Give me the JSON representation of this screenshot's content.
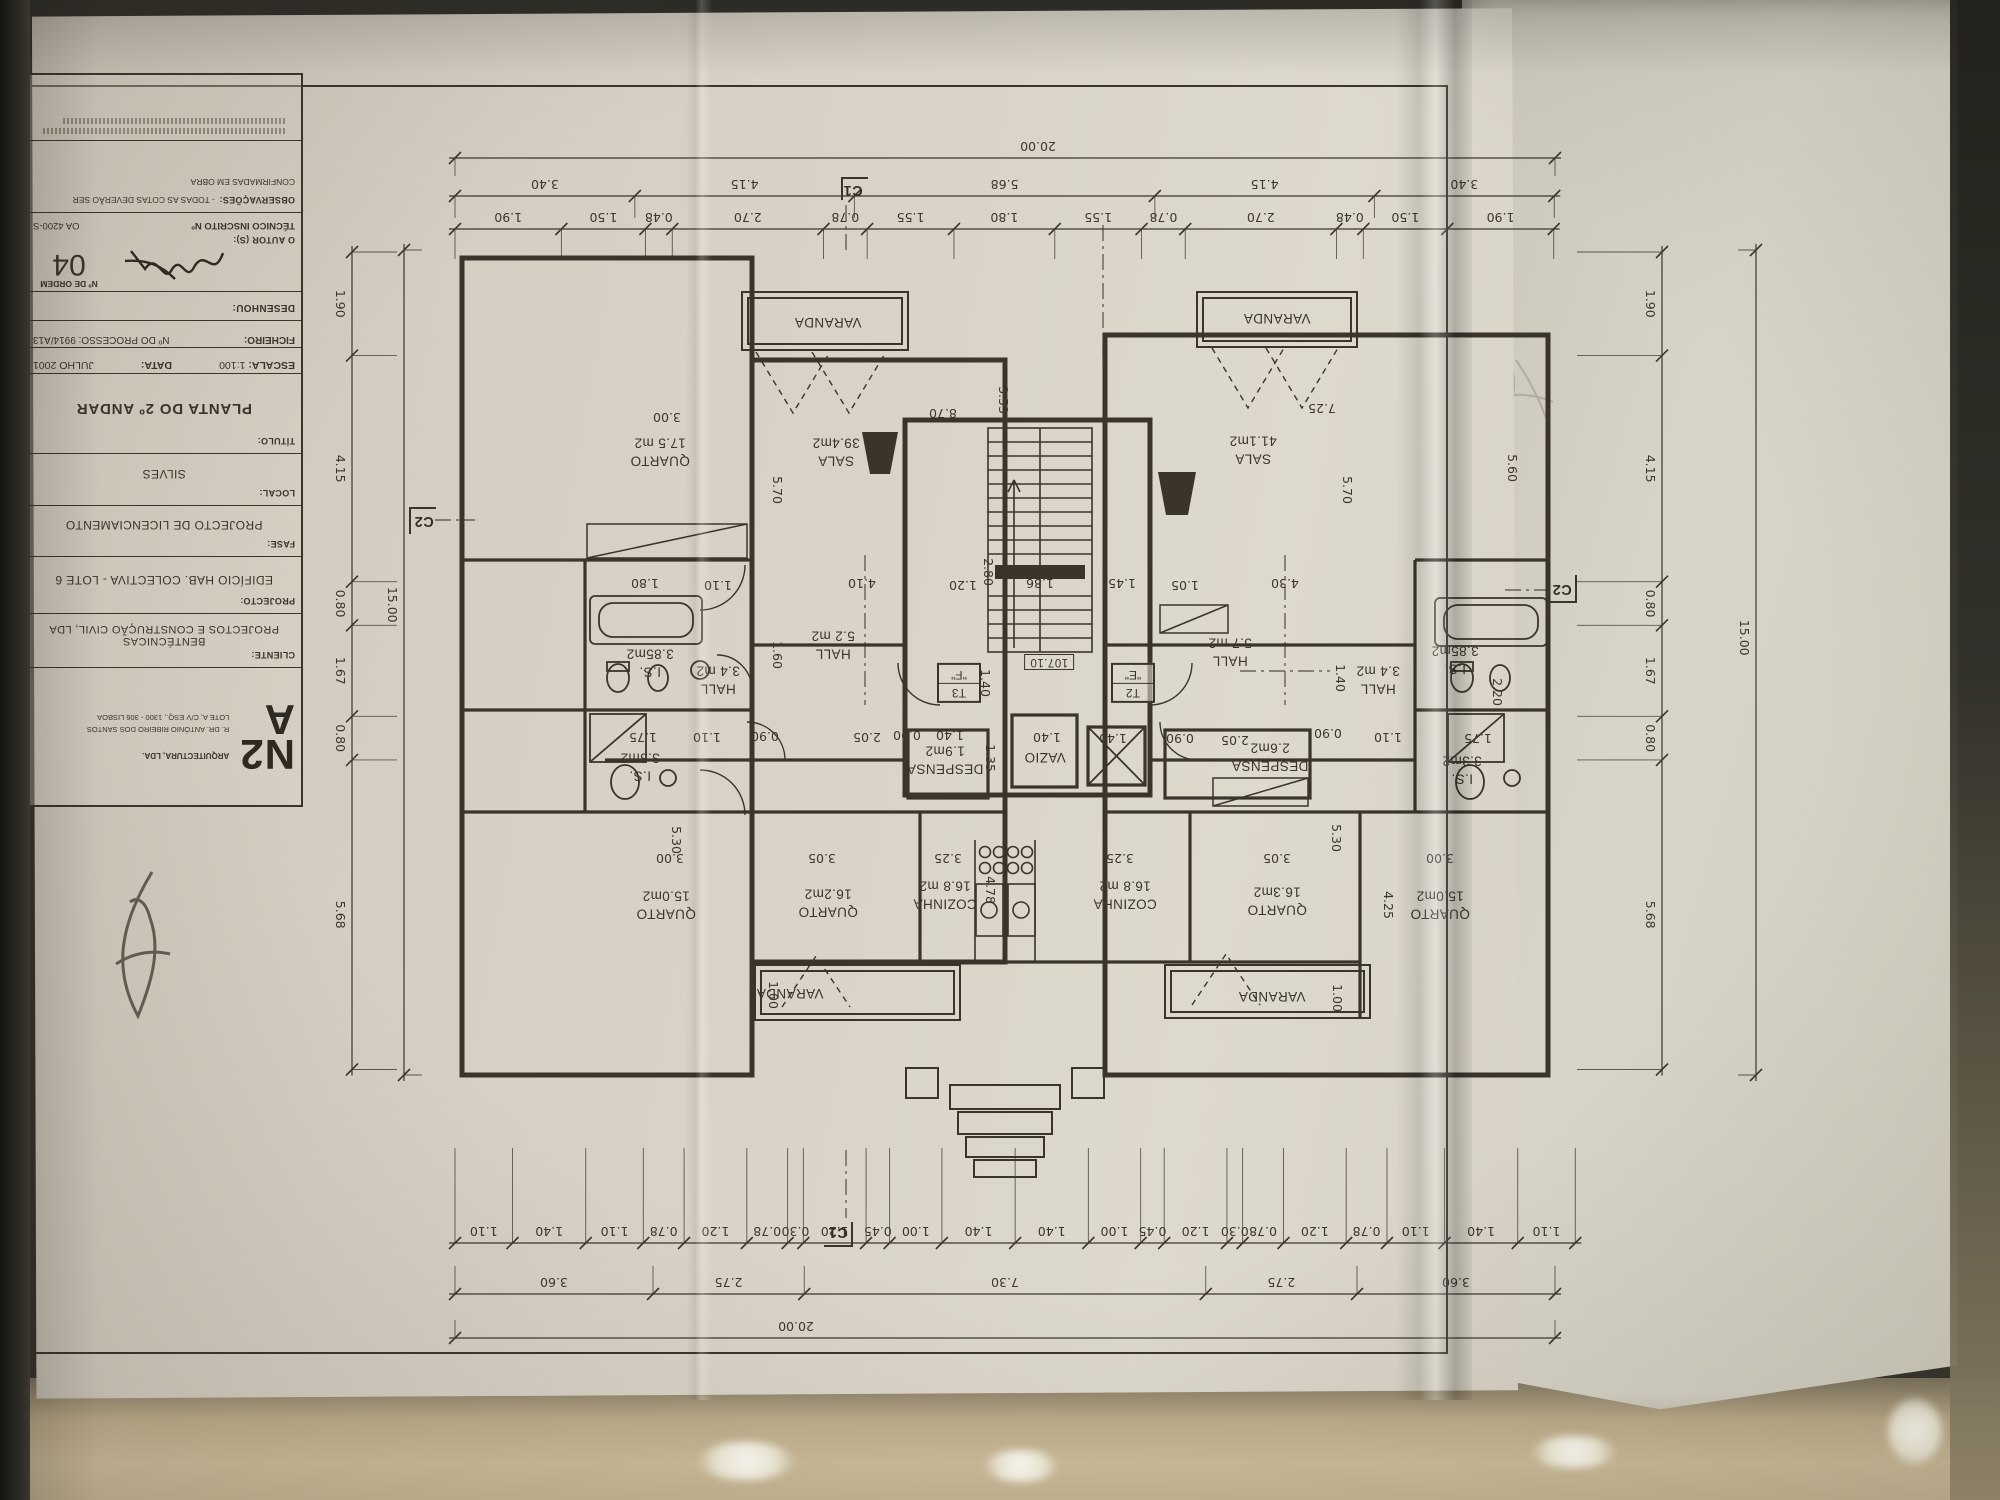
{
  "colors": {
    "ink": "#3a342b",
    "paper": "#d6cfc4",
    "dim_ink": "#3d362c"
  },
  "title_block": {
    "observacoes_label": "OBSERVAÇÕES:",
    "observacoes_value": "- TODAS AS COTAS DEVERÃO SER CONFIRMADAS EM OBRA",
    "tecnico_label": "TÉCNICO INSCRITO Nº",
    "tecnico_value": "OA 4200-S",
    "autor_label": "O AUTOR (S):",
    "ordem_label": "Nº DE ORDEM",
    "ordem_value": "04",
    "desenhou_label": "DESENHOU:",
    "ficheiro_label": "FICHEIRO:",
    "processo_value": "Nº DO PROCESSO: 9914/A13",
    "escala_label": "ESCALA:",
    "escala_value": "1:100",
    "data_label": "DATA:",
    "data_value": "JULHO 2001",
    "titulo_label": "TÍTULO:",
    "titulo_value": "PLANTA DO 2º ANDAR",
    "local_label": "LOCAL:",
    "local_value": "SILVES",
    "fase_label": "FASE:",
    "fase_value": "PROJECTO DE LICENCIAMENTO",
    "projecto_label": "PROJECTO:",
    "projecto_value": "EDIFÍCIO  HAB. COLECTIVA - LOTE 6",
    "cliente_label": "CLIENTE:",
    "cliente_value_1": "BENTÉCNICAS",
    "cliente_value_2": "PROJECTOS E CONSTRUÇÃO CIVIL, LDA",
    "logo_line1": "N2",
    "logo_line2": "A",
    "logo_sub": "ARQUITECTURA, LDA.",
    "address_1": "R. DR. ANTÓNIO RIBEIRO DOS SANTOS",
    "address_2": "LOTE A, C/V ESQ., 1300 - 306 LISBOA"
  },
  "plan": {
    "rooms": [
      {
        "id": "varanda-top-left",
        "x": 828,
        "y": 322,
        "lines": [
          "VARANDA"
        ]
      },
      {
        "id": "varanda-top-right",
        "x": 1277,
        "y": 318,
        "lines": [
          "VARANDA"
        ]
      },
      {
        "id": "quarto-17-5",
        "x": 660,
        "y": 452,
        "lines": [
          "QUARTO",
          "17.5 m2"
        ]
      },
      {
        "id": "sala-39-4",
        "x": 836,
        "y": 452,
        "lines": [
          "SALA",
          "39.4m2"
        ]
      },
      {
        "id": "sala-41-1",
        "x": 1253,
        "y": 450,
        "lines": [
          "SALA",
          "41.1m2"
        ]
      },
      {
        "id": "hall-3-4-left",
        "x": 718,
        "y": 680,
        "lines": [
          "HALL",
          "3.4 m2"
        ]
      },
      {
        "id": "hall-5-2",
        "x": 833,
        "y": 645,
        "lines": [
          "HALL",
          "5.2 m2"
        ]
      },
      {
        "id": "is-3-85-left",
        "x": 650,
        "y": 663,
        "lines": [
          "I.S.",
          "3.85m2"
        ]
      },
      {
        "id": "is-3-3-left",
        "x": 640,
        "y": 767,
        "lines": [
          "I.S.",
          "3.3m2"
        ]
      },
      {
        "id": "despensa-1-9",
        "x": 945,
        "y": 760,
        "lines": [
          "DESPENSA",
          "1.9m2"
        ]
      },
      {
        "id": "vazio",
        "x": 1045,
        "y": 757,
        "lines": [
          "VAZIO"
        ]
      },
      {
        "id": "hall-5-7",
        "x": 1230,
        "y": 652,
        "lines": [
          "HALL",
          "5.7 m2"
        ]
      },
      {
        "id": "hall-3-4-right",
        "x": 1378,
        "y": 680,
        "lines": [
          "HALL",
          "3.4 m2"
        ]
      },
      {
        "id": "despensa-2-6",
        "x": 1270,
        "y": 757,
        "lines": [
          "DESPENSA",
          "2.6m2"
        ]
      },
      {
        "id": "is-3-85-right",
        "x": 1455,
        "y": 660,
        "lines": [
          "I.S.",
          "3.85m2"
        ]
      },
      {
        "id": "is-3-3-right",
        "x": 1462,
        "y": 770,
        "lines": [
          "I.S.",
          "3.3m2"
        ]
      },
      {
        "id": "quarto-15-left",
        "x": 666,
        "y": 905,
        "lines": [
          "QUARTO",
          "15.0m2"
        ]
      },
      {
        "id": "quarto-16-2",
        "x": 828,
        "y": 903,
        "lines": [
          "QUARTO",
          "16.2m2"
        ]
      },
      {
        "id": "cozinha-left",
        "x": 945,
        "y": 895,
        "lines": [
          "COZINHA",
          "16.8 m2"
        ]
      },
      {
        "id": "cozinha-right",
        "x": 1125,
        "y": 895,
        "lines": [
          "COZINHA",
          "16.8 m2"
        ]
      },
      {
        "id": "quarto-16-3",
        "x": 1277,
        "y": 901,
        "lines": [
          "QUARTO",
          "16.3m2"
        ]
      },
      {
        "id": "quarto-15-right",
        "x": 1440,
        "y": 905,
        "lines": [
          "QUARTO",
          "15.0m2"
        ]
      },
      {
        "id": "varanda-bottom-left",
        "x": 790,
        "y": 993,
        "lines": [
          "VARANDA"
        ]
      },
      {
        "id": "varanda-bottom-right",
        "x": 1272,
        "y": 996,
        "lines": [
          "VARANDA"
        ]
      }
    ],
    "unit_tags": [
      {
        "id": "t3-f",
        "line1": "T3",
        "line2": "\"F\"",
        "x": 959,
        "y": 683
      },
      {
        "id": "t2-e",
        "line1": "T2",
        "line2": "\"E\"",
        "x": 1133,
        "y": 683
      }
    ],
    "level_label": {
      "text": "107.10",
      "x": 1049,
      "y": 662
    },
    "section_markers": [
      {
        "text": "C1",
        "x": 853,
        "y": 190
      },
      {
        "text": "C1",
        "x": 838,
        "y": 1232
      },
      {
        "text": "C2",
        "x": 424,
        "y": 521
      },
      {
        "text": "C2",
        "x": 1562,
        "y": 589
      }
    ]
  },
  "dims": {
    "chains": [
      {
        "id": "top-overall",
        "orient": "h",
        "pos": 158,
        "start": 455,
        "scale": 55.0,
        "ext_dir": 1,
        "ext_len": 18,
        "label_frac": 0.53,
        "values": [
          "20.00"
        ]
      },
      {
        "id": "top-mid",
        "orient": "h",
        "pos": 196,
        "start": 455,
        "scale": 52.9,
        "ext_dir": 1,
        "ext_len": 22,
        "values": [
          "3.40",
          "4.15",
          "5.68",
          "4.15",
          "3.40"
        ]
      },
      {
        "id": "top-detail",
        "orient": "h",
        "pos": 229,
        "start": 455,
        "scale": 56.0,
        "ext_dir": 1,
        "ext_len": 30,
        "values": [
          "1.90",
          "1.50",
          "0.48",
          "2.70",
          "0.78",
          "1.55",
          "1.80",
          "1.55",
          "0.78",
          "2.70",
          "0.48",
          "1.50",
          "1.90"
        ]
      },
      {
        "id": "bottom-detail",
        "orient": "h",
        "pos": 1243,
        "start": 455,
        "scale": 52.3,
        "ext_dir": -1,
        "ext_len": 95,
        "values": [
          "1.10",
          "1.40",
          "1.10",
          "0.78",
          "1.20",
          "0.78",
          "0.30",
          "1.20",
          "0.45",
          "1.00",
          "1.40",
          "1.40",
          "1.00",
          "0.45",
          "1.20",
          "0.30",
          "0.78",
          "1.20",
          "0.78",
          "1.10",
          "1.40",
          "1.10"
        ]
      },
      {
        "id": "bottom-mid",
        "orient": "h",
        "pos": 1294,
        "start": 455,
        "scale": 55.0,
        "ext_dir": -1,
        "ext_len": 28,
        "values": [
          "3.60",
          "2.75",
          "7.30",
          "2.75",
          "3.60"
        ]
      },
      {
        "id": "bottom-overall",
        "orient": "h",
        "pos": 1338,
        "start": 455,
        "scale": 55.0,
        "ext_dir": -1,
        "ext_len": 18,
        "label_frac": 0.31,
        "values": [
          "20.00"
        ]
      },
      {
        "id": "left-detail",
        "orient": "v",
        "pos": 352,
        "start": 252,
        "scale": 54.5,
        "ext_dir": 1,
        "ext_len": 45,
        "values": [
          "1.90",
          "4.15",
          "0.80",
          "1.67",
          "0.80",
          "5.68"
        ]
      },
      {
        "id": "left-overall",
        "orient": "v",
        "pos": 404,
        "start": 250,
        "scale": 55.0,
        "ext_dir": 1,
        "ext_len": 18,
        "label_frac": 0.43,
        "values": [
          "15.00"
        ]
      },
      {
        "id": "right-detail",
        "orient": "v",
        "pos": 1662,
        "start": 252,
        "scale": 54.5,
        "ext_dir": -1,
        "ext_len": 85,
        "values": [
          "1.90",
          "4.15",
          "0.80",
          "1.67",
          "0.80",
          "5.68"
        ]
      },
      {
        "id": "right-overall",
        "orient": "v",
        "pos": 1756,
        "start": 250,
        "scale": 55.0,
        "ext_dir": -1,
        "ext_len": 18,
        "label_frac": 0.47,
        "values": [
          "15.00"
        ]
      }
    ],
    "singles": [
      {
        "t": "3.00",
        "x": 667,
        "y": 417,
        "r": 180
      },
      {
        "t": "8.70",
        "x": 943,
        "y": 413,
        "r": 180
      },
      {
        "t": "7.25",
        "x": 1322,
        "y": 408,
        "r": 180
      },
      {
        "t": "5.70",
        "x": 777,
        "y": 490,
        "r": 90
      },
      {
        "t": "3.53",
        "x": 1003,
        "y": 400,
        "r": 90
      },
      {
        "t": "5.70",
        "x": 1347,
        "y": 490,
        "r": 90
      },
      {
        "t": "5.60",
        "x": 1512,
        "y": 468,
        "r": 90
      },
      {
        "t": "1.80",
        "x": 645,
        "y": 583,
        "r": 180
      },
      {
        "t": "1.10",
        "x": 718,
        "y": 585,
        "r": 180
      },
      {
        "t": "4.10",
        "x": 862,
        "y": 583,
        "r": 180
      },
      {
        "t": "1.20",
        "x": 963,
        "y": 585,
        "r": 180
      },
      {
        "t": "1.86",
        "x": 1040,
        "y": 583,
        "r": 180
      },
      {
        "t": "1.45",
        "x": 1122,
        "y": 583,
        "r": 180
      },
      {
        "t": "1.05",
        "x": 1185,
        "y": 585,
        "r": 180
      },
      {
        "t": "4.30",
        "x": 1285,
        "y": 583,
        "r": 180
      },
      {
        "t": "2.80",
        "x": 988,
        "y": 572,
        "r": 90
      },
      {
        "t": "1.60",
        "x": 777,
        "y": 655,
        "r": 90
      },
      {
        "t": "1.40",
        "x": 985,
        "y": 683,
        "r": 90
      },
      {
        "t": "1.40",
        "x": 1340,
        "y": 678,
        "r": 90
      },
      {
        "t": "1.75",
        "x": 643,
        "y": 737,
        "r": 180
      },
      {
        "t": "1.10",
        "x": 707,
        "y": 737,
        "r": 180
      },
      {
        "t": "0.90",
        "x": 765,
        "y": 736,
        "r": 180
      },
      {
        "t": "2.05",
        "x": 867,
        "y": 737,
        "r": 180
      },
      {
        "t": "0.90",
        "x": 907,
        "y": 735,
        "r": 180
      },
      {
        "t": "1.40",
        "x": 950,
        "y": 735,
        "r": 180
      },
      {
        "t": "1.35",
        "x": 990,
        "y": 758,
        "r": 90
      },
      {
        "t": "1.40",
        "x": 1047,
        "y": 737,
        "r": 180
      },
      {
        "t": "1.40",
        "x": 1113,
        "y": 738,
        "r": 180
      },
      {
        "t": "0.90",
        "x": 1180,
        "y": 738,
        "r": 180
      },
      {
        "t": "2.05",
        "x": 1235,
        "y": 740,
        "r": 180
      },
      {
        "t": "0.90",
        "x": 1328,
        "y": 733,
        "r": 180
      },
      {
        "t": "1.10",
        "x": 1388,
        "y": 737,
        "r": 180
      },
      {
        "t": "1.75",
        "x": 1478,
        "y": 738,
        "r": 180
      },
      {
        "t": "2.20",
        "x": 1497,
        "y": 692,
        "r": 90
      },
      {
        "t": "3.00",
        "x": 670,
        "y": 858,
        "r": 180
      },
      {
        "t": "3.05",
        "x": 822,
        "y": 858,
        "r": 180
      },
      {
        "t": "3.25",
        "x": 948,
        "y": 858,
        "r": 180
      },
      {
        "t": "3.25",
        "x": 1120,
        "y": 858,
        "r": 180
      },
      {
        "t": "3.05",
        "x": 1277,
        "y": 858,
        "r": 180
      },
      {
        "t": "3.00",
        "x": 1440,
        "y": 858,
        "r": 180
      },
      {
        "t": "5.30",
        "x": 676,
        "y": 840,
        "r": 90
      },
      {
        "t": "5.30",
        "x": 1336,
        "y": 838,
        "r": 90
      },
      {
        "t": "4.78",
        "x": 990,
        "y": 890,
        "r": 90
      },
      {
        "t": "4.25",
        "x": 1388,
        "y": 905,
        "r": 90
      },
      {
        "t": "1.00",
        "x": 773,
        "y": 995,
        "r": 90
      },
      {
        "t": "1.00",
        "x": 1337,
        "y": 998,
        "r": 90
      }
    ]
  }
}
